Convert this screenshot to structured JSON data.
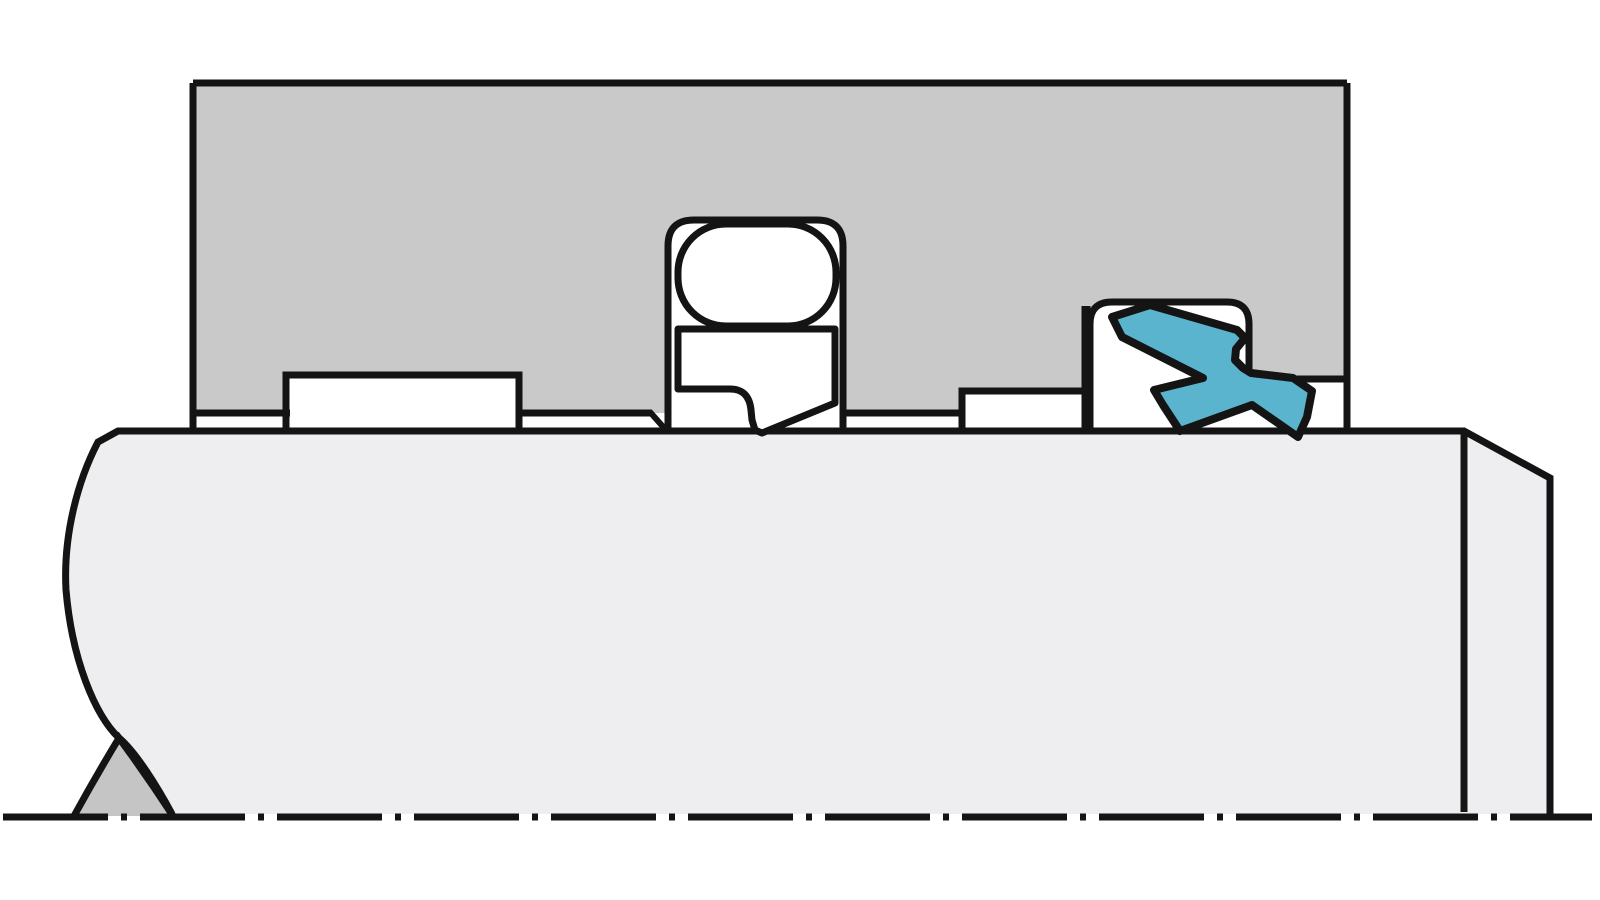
{
  "diagram": {
    "name": "rod-seal-cross-section",
    "description": "Technical cross-section drawing of a hydraulic rod sealing configuration: gray housing/gland block above, light gray rod below with break lines, an O-ring energized slipper seal in a central groove, and a blue twisted wiper/scraper seal in the right groove. Dash-dot centerline along the bottom.",
    "canvas": {
      "width": 1600,
      "height": 900,
      "background": "#ffffff"
    },
    "palette": {
      "housing_gray": "#c9c9c9",
      "rod_gray": "#eeeef0",
      "break_wedge_gray": "#c5c5c5",
      "seal_white": "#ffffff",
      "wiper_blue": "#5bb4cd",
      "line_black": "#141414"
    },
    "shapes": [
      {
        "name": "rod-body-fill",
        "type": "path",
        "d": "M172,814 C158,788 136,752 119,738 C95,715 72,660 66,590 C63,535 78,480 98,442 L118,431 H1464 L1550,478 V814 Z",
        "fill": "#eeeef0",
        "stroke": "none",
        "width": 0
      },
      {
        "name": "rod-body-outline",
        "type": "path",
        "d": "M172,814 C158,788 136,752 119,738 C95,715 72,660 66,590 C63,535 78,480 98,442 L118,431 H1464 L1550,478 V814",
        "fill": "none",
        "stroke": "#141414",
        "width": 7,
        "linejoin": "miter"
      },
      {
        "name": "rod-break-wedge",
        "type": "path",
        "d": "M74,816 Q96,776 119,738 Q147,776 173,816",
        "fill": "#c5c5c5",
        "stroke": "#141414",
        "width": 7
      },
      {
        "name": "housing-fill",
        "type": "path",
        "d": "M193,83 H1347 V379 H1249 V324 Q1249,302 1227,302 H1112 Q1090,302 1090,324 V391 H962 V413 H843 V246 Q843,220 817,220 H694 Q668,220 668,246 V413 H519 V375 H286 V413 H193 Z",
        "fill": "#c9c9c9",
        "stroke": "none",
        "width": 0
      },
      {
        "name": "housing-bore-line-left",
        "type": "path",
        "d": "M193,413 H290",
        "fill": "none",
        "stroke": "#141414",
        "width": 7
      },
      {
        "name": "housing-notch-left-outline",
        "type": "path",
        "d": "M286,431 V375 H519 V431",
        "fill": "none",
        "stroke": "#141414",
        "width": 7
      },
      {
        "name": "housing-bore-line-mid",
        "type": "path",
        "d": "M516,413 H652",
        "fill": "none",
        "stroke": "#141414",
        "width": 7
      },
      {
        "name": "housing-bore-chamfer",
        "type": "path",
        "d": "M650,412 L665,429",
        "fill": "none",
        "stroke": "#141414",
        "width": 6
      },
      {
        "name": "seal-groove-outline",
        "type": "path",
        "d": "M668,431 V246 Q668,220 694,220 H817 Q843,220 843,246 V431",
        "fill": "none",
        "stroke": "#141414",
        "width": 7
      },
      {
        "name": "oring-seal",
        "type": "rect",
        "x": 678,
        "y": 224,
        "w": 158,
        "h": 102,
        "rx": 48,
        "fill": "#ffffff",
        "stroke": "#141414",
        "width": 7
      },
      {
        "name": "slipper-seal",
        "type": "path",
        "d": "M678,329 H835 V403 L762,433 L755,430 L752,420 L751,410 Q749,389 730,389 H678 Z",
        "fill": "#ffffff",
        "stroke": "#141414",
        "width": 7,
        "linejoin": "round"
      },
      {
        "name": "housing-bore-line-right",
        "type": "path",
        "d": "M845,413 H962",
        "fill": "none",
        "stroke": "#141414",
        "width": 7
      },
      {
        "name": "housing-notch-right-outline",
        "type": "path",
        "d": "M962,431 V391 H1082",
        "fill": "none",
        "stroke": "#141414",
        "width": 7
      },
      {
        "name": "wiper-groove-wall",
        "type": "path",
        "d": "M1086,431 V306",
        "fill": "none",
        "stroke": "#141414",
        "width": 9
      },
      {
        "name": "wiper-groove-outline",
        "type": "path",
        "d": "M1090,431 V324 Q1090,302 1112,302 H1227 Q1249,302 1249,324 V379",
        "fill": "none",
        "stroke": "#141414",
        "width": 7
      },
      {
        "name": "housing-step-line",
        "type": "path",
        "d": "M1249,379 H1347",
        "fill": "none",
        "stroke": "#141414",
        "width": 7
      },
      {
        "name": "housing-top-edge",
        "type": "path",
        "d": "M193,83 H1347",
        "fill": "none",
        "stroke": "#141414",
        "width": 7
      },
      {
        "name": "housing-left-edge",
        "type": "path",
        "d": "M193,83 V431",
        "fill": "none",
        "stroke": "#141414",
        "width": 7
      },
      {
        "name": "housing-right-edge",
        "type": "path",
        "d": "M1347,83 V431",
        "fill": "none",
        "stroke": "#141414",
        "width": 7
      },
      {
        "name": "wiper-seal-blue",
        "type": "path",
        "d": "M1112,317 L1150,305 L1237,330 L1245,338 L1236,349 L1235,360 L1243,368 L1251,373 L1293,378 L1312,391 L1307,417 L1298,437 L1252,405 L1180,431 L1163,405 L1154,390 L1203,378 L1122,337 Z",
        "fill": "#5bb4cd",
        "stroke": "#141414",
        "width": 8,
        "linejoin": "round"
      },
      {
        "name": "rod-end-face-line",
        "type": "path",
        "d": "M1464,431 V812",
        "fill": "none",
        "stroke": "#141414",
        "width": 7
      },
      {
        "name": "centerline",
        "type": "path",
        "d": "M3,817 H1592",
        "fill": "none",
        "stroke": "#141414",
        "width": 7,
        "dash": "105 13 6 13"
      }
    ]
  }
}
